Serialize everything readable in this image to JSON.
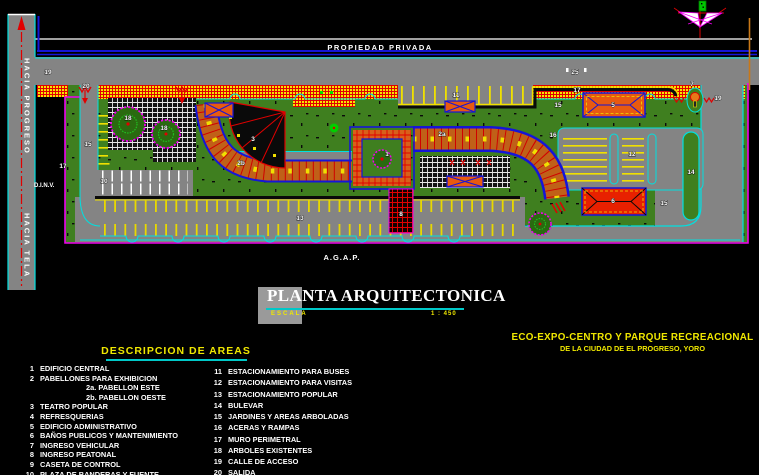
{
  "plan": {
    "texts": {
      "propiedad_privada": "PROPIEDAD PRIVADA",
      "agap": "A.G.A.P.",
      "dinv": "D.I.N.V.",
      "hacia_progreso": "HACIA PROGRESO",
      "hacia_tela": "HACIA TELA"
    },
    "labels": [
      {
        "t": "19",
        "x": 48,
        "y": 74
      },
      {
        "t": "20",
        "x": 86,
        "y": 88
      },
      {
        "t": "25",
        "x": 575,
        "y": 74
      },
      {
        "t": "11",
        "x": 456,
        "y": 97
      },
      {
        "t": "17",
        "x": 577,
        "y": 92
      },
      {
        "t": "15",
        "x": 558,
        "y": 107
      },
      {
        "t": "5",
        "x": 613,
        "y": 107
      },
      {
        "t": "7",
        "x": 692,
        "y": 86
      },
      {
        "t": "19",
        "x": 718,
        "y": 100
      },
      {
        "t": "16",
        "x": 553,
        "y": 137
      },
      {
        "t": "12",
        "x": 632,
        "y": 156
      },
      {
        "t": "14",
        "x": 691,
        "y": 174
      },
      {
        "t": "15",
        "x": 664,
        "y": 205
      },
      {
        "t": "6",
        "x": 613,
        "y": 203
      },
      {
        "t": "18",
        "x": 128,
        "y": 120
      },
      {
        "t": "18",
        "x": 164,
        "y": 130
      },
      {
        "t": "15",
        "x": 88,
        "y": 146
      },
      {
        "t": "10",
        "x": 104,
        "y": 183
      },
      {
        "t": "13",
        "x": 300,
        "y": 220
      },
      {
        "t": "1",
        "x": 387,
        "y": 156
      },
      {
        "t": "3",
        "x": 253,
        "y": 141
      },
      {
        "t": "2a",
        "x": 442,
        "y": 136
      },
      {
        "t": "2b",
        "x": 241,
        "y": 165
      },
      {
        "t": "8",
        "x": 401,
        "y": 216
      },
      {
        "t": "17",
        "x": 63,
        "y": 168
      }
    ]
  },
  "title_block": {
    "title": "PLANTA ARQUITECTONICA",
    "scale_label": "ESCALA",
    "scale_value": "1 : 450"
  },
  "project": {
    "line1": "ECO-EXPO-CENTRO Y PARQUE RECREACIONAL",
    "line2": "DE LA CIUDAD DE EL PROGRESO, YORO"
  },
  "legend": {
    "heading": "DESCRIPCION DE AREAS",
    "left": [
      {
        "num": "1",
        "label": "EDIFICIO CENTRAL"
      },
      {
        "num": "2",
        "label": "PABELLONES PARA EXHIBICION"
      },
      {
        "num": "",
        "label": "2a. PABELLON ESTE",
        "indent": true
      },
      {
        "num": "",
        "label": "2b. PABELLON OESTE",
        "indent": true
      },
      {
        "num": "3",
        "label": "TEATRO POPULAR"
      },
      {
        "num": "4",
        "label": "REFRESQUERIAS"
      },
      {
        "num": "5",
        "label": "EDIFICIO ADMINISTRATIVO"
      },
      {
        "num": "6",
        "label": "BAÑOS PUBLICOS Y MANTENIMIENTO"
      },
      {
        "num": "7",
        "label": "INGRESO VEHICULAR"
      },
      {
        "num": "8",
        "label": "INGRESO PEATONAL"
      },
      {
        "num": "9",
        "label": "CASETA DE CONTROL"
      },
      {
        "num": "10",
        "label": "PLAZA DE BANDERAS Y FUENTE"
      }
    ],
    "right": [
      {
        "num": "11",
        "label": "ESTACIONAMIENTO PARA BUSES"
      },
      {
        "num": "12",
        "label": "ESTACIONAMIENTO PARA VISITAS"
      },
      {
        "num": "13",
        "label": "ESTACIONAMIENTO POPULAR"
      },
      {
        "num": "14",
        "label": "BULEVAR"
      },
      {
        "num": "15",
        "label": "JARDINES Y AREAS ARBOLADAS"
      },
      {
        "num": "16",
        "label": "ACERAS Y RAMPAS"
      },
      {
        "num": "17",
        "label": "MURO PERIMETRAL"
      },
      {
        "num": "18",
        "label": "ARBOLES EXISTENTES"
      },
      {
        "num": "19",
        "label": "CALLE DE ACCESO"
      },
      {
        "num": "20",
        "label": "SALIDA"
      }
    ]
  },
  "colors": {
    "background": "#000000",
    "road_gray": "#848484",
    "site_green": "#3f7f1f",
    "cad_cyan": "#00e0e0",
    "cad_magenta": "#f000f0",
    "cad_yellow": "#f0e000",
    "cad_red": "#e00000",
    "cad_blue": "#1515d8",
    "band_orange": "#c06018",
    "heading_yellow": "#f0e800",
    "underline_cyan": "#00c8c8"
  }
}
